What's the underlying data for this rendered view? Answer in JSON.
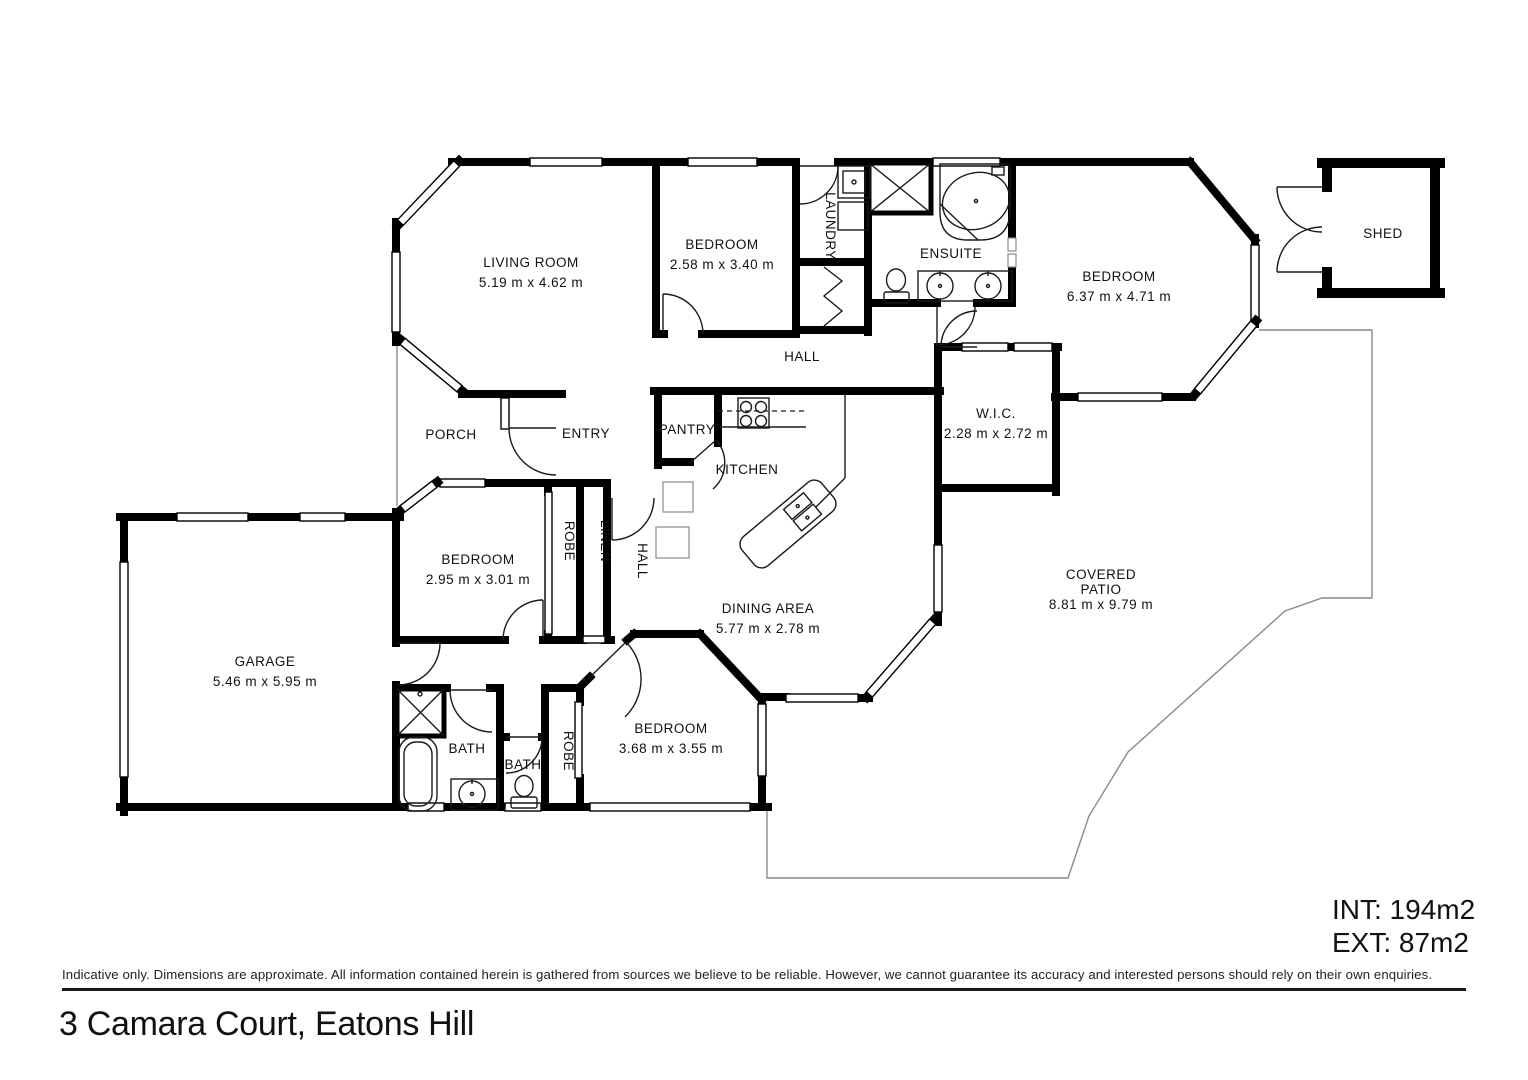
{
  "meta": {
    "address_title": "3 Camara Court, Eatons Hill"
  },
  "disclaimer": "Indicative only. Dimensions are approximate. All information contained herein is gathered from sources we believe to be reliable. However, we cannot guarantee its accuracy and interested persons should rely on their own enquiries.",
  "areas": {
    "internal": "INT: 194m2",
    "external": "EXT: 87m2"
  },
  "colors": {
    "walls": "#000000",
    "fixtures": "#1a1a1a",
    "site_outline": "#8a8a8a",
    "background": "#ffffff"
  },
  "rooms": [
    {
      "id": "living-room",
      "name": "LIVING ROOM",
      "dims": "5.19 m x 4.62 m",
      "x": 531,
      "y": 267
    },
    {
      "id": "bedroom-2",
      "name": "BEDROOM",
      "dims": "2.58 m x 3.40 m",
      "x": 722,
      "y": 249
    },
    {
      "id": "laundry",
      "name": "LAUNDRY",
      "x": 826,
      "y": 226,
      "rot": 90
    },
    {
      "id": "ensuite",
      "name": "ENSUITE",
      "x": 951,
      "y": 258
    },
    {
      "id": "master-bedroom",
      "name": "BEDROOM",
      "dims": "6.37 m x 4.71 m",
      "x": 1119,
      "y": 281
    },
    {
      "id": "shed",
      "name": "SHED",
      "x": 1383,
      "y": 238
    },
    {
      "id": "hall-main",
      "name": "HALL",
      "x": 802,
      "y": 361
    },
    {
      "id": "wic",
      "name": "W.I.C.",
      "dims": "2.28 m x 2.72 m",
      "x": 996,
      "y": 418
    },
    {
      "id": "porch",
      "name": "PORCH",
      "x": 451,
      "y": 439
    },
    {
      "id": "entry",
      "name": "ENTRY",
      "x": 586,
      "y": 438
    },
    {
      "id": "pantry",
      "name": "PANTRY",
      "x": 687,
      "y": 434
    },
    {
      "id": "kitchen",
      "name": "KITCHEN",
      "x": 747,
      "y": 474
    },
    {
      "id": "robe-bed3",
      "name": "ROBE",
      "x": 565,
      "y": 541,
      "rot": 90
    },
    {
      "id": "linen",
      "name": "LINEN",
      "x": 601,
      "y": 541,
      "rot": 90
    },
    {
      "id": "hall-passage",
      "name": "HALL",
      "x": 638,
      "y": 561,
      "rot": 90
    },
    {
      "id": "bedroom-3",
      "name": "BEDROOM",
      "dims": "2.95 m x 3.01 m",
      "x": 478,
      "y": 564
    },
    {
      "id": "garage",
      "name": "GARAGE",
      "dims": "5.46 m x 5.95 m",
      "x": 265,
      "y": 666
    },
    {
      "id": "dining-area",
      "name": "DINING AREA",
      "dims": "5.77 m x 2.78 m",
      "x": 768,
      "y": 613
    },
    {
      "id": "covered-patio",
      "name": "COVERED\nPATIO",
      "dims": "8.81 m x 9.79 m",
      "x": 1101,
      "y": 579,
      "lineHeight": 15
    },
    {
      "id": "bath-main",
      "name": "BATH",
      "x": 467,
      "y": 753
    },
    {
      "id": "bath-wc",
      "name": "BATH",
      "x": 523,
      "y": 769
    },
    {
      "id": "robe-bed4",
      "name": "ROBE",
      "x": 564,
      "y": 751,
      "rot": 90
    },
    {
      "id": "bedroom-4",
      "name": "BEDROOM",
      "dims": "3.68 m x 3.55 m",
      "x": 671,
      "y": 733
    }
  ]
}
